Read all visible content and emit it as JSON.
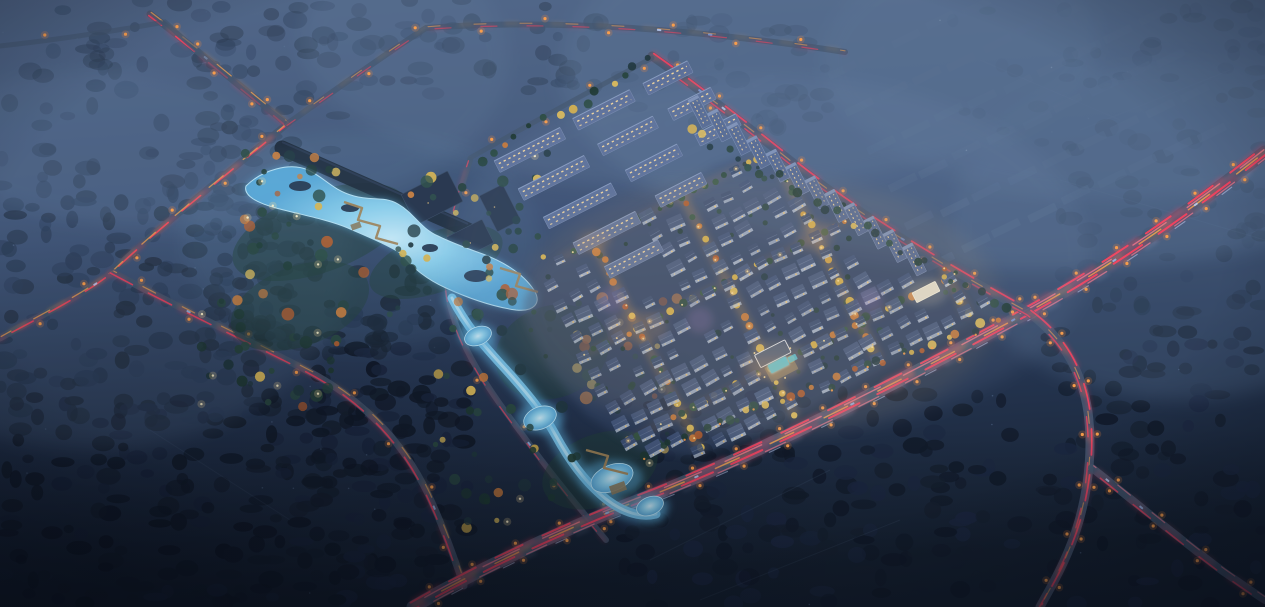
{
  "scene": {
    "description": "aerial-night-rendering-of-residential-development-with-park-and-roads",
    "canvas": {
      "width": 1265,
      "height": 607
    },
    "palette": {
      "bg_top": "#4d6183",
      "bg_mid": "#394d70",
      "bg_low": "#24344f",
      "bg_bottom": "#15202f",
      "haze": "#5f7899",
      "forest": [
        "#1c2b41",
        "#17212f",
        "#233450",
        "#1a2638"
      ],
      "forest_dark": [
        "#121b2a",
        "#16202f",
        "#1b2740",
        "#101827"
      ],
      "village": "#4b5f80",
      "road": "#45576f",
      "trail_red": "#f5415f",
      "trail_pink": "#ff7b92",
      "trail_amber": "#ffaa4e",
      "trail_head": "#c9d9ff",
      "lamp": "#ffa04a",
      "lamp_halo": "#ff8c3a",
      "water": "#7cc8ee",
      "water_hi": "#c8eefc",
      "water_halo": "#5fb5e5",
      "autumn": [
        "#cd7d3a",
        "#dcb54c",
        "#b35c2c",
        "#e3c05a"
      ],
      "green": [
        "#27443c",
        "#1f3a33",
        "#2c4c42",
        "#21383f"
      ],
      "lane_warm": [
        "#dcb54c",
        "#e3c05a",
        "#d9a844",
        "#dcb54c",
        "#cd7d3a",
        "#b35c2c",
        "#3a5a46"
      ],
      "lane_green": [
        "#3a5a46",
        "#2e4c3e",
        "#cd7d3a",
        "#3a5a46",
        "#dcb54c",
        "#2e4c3e"
      ],
      "boardwalk": "#a08357",
      "roof": [
        "#41547a",
        "#485b80",
        "#3c4f73"
      ],
      "facade": "#c3cfe2",
      "window": "#ffd27c",
      "window2": "#ffe6a8",
      "slab": "#5d7099",
      "slab_win": "#ffdf9f",
      "slab_edge": "#8fa3c6",
      "tower": "#566a92",
      "tower_cap": "#8598bc",
      "pool": "#41c8e4",
      "plaza": "#8d7f62",
      "club_roof": "#3e5070",
      "club_rim": "#e8eef8",
      "office": "#e6e0cf",
      "glow_warm": "#ffab55",
      "glow_purple": "#c98fd6",
      "cars": [
        "#9db8ea",
        "#b8ccf4",
        "#7f9cd8"
      ],
      "dark_building": "#232e45",
      "dark_building_edge": "#37465f",
      "wall": "#1c2736"
    },
    "haze_spots": [
      [
        1040,
        70,
        480,
        200,
        0.4
      ],
      [
        700,
        40,
        400,
        150,
        0.32
      ],
      [
        180,
        60,
        330,
        170,
        0.28
      ],
      [
        90,
        260,
        260,
        190,
        0.22
      ],
      [
        1180,
        230,
        230,
        170,
        0.26
      ],
      [
        1120,
        60,
        300,
        140,
        0.3
      ]
    ],
    "forest_patches": [
      {
        "x": 0,
        "y": 30,
        "w": 340,
        "h": 190,
        "n": 80,
        "o": 0.5,
        "dark": false
      },
      {
        "x": 0,
        "y": 190,
        "w": 290,
        "h": 230,
        "n": 130,
        "o": 0.8,
        "dark": false
      },
      {
        "x": 0,
        "y": 390,
        "w": 470,
        "h": 217,
        "n": 200,
        "o": 0.95,
        "dark": true
      },
      {
        "x": 250,
        "y": 320,
        "w": 230,
        "h": 250,
        "n": 90,
        "o": 0.9,
        "dark": true
      },
      {
        "x": 620,
        "y": 390,
        "w": 400,
        "h": 217,
        "n": 160,
        "o": 0.9,
        "dark": true
      },
      {
        "x": 1040,
        "y": 330,
        "w": 225,
        "h": 277,
        "n": 90,
        "o": 0.85,
        "dark": true
      },
      {
        "x": 1055,
        "y": 140,
        "w": 210,
        "h": 175,
        "n": 50,
        "o": 0.5,
        "dark": false
      },
      {
        "x": 330,
        "y": 0,
        "w": 290,
        "h": 95,
        "n": 45,
        "o": 0.5,
        "dark": false
      },
      {
        "x": 55,
        "y": 0,
        "w": 270,
        "h": 70,
        "n": 30,
        "o": 0.45,
        "dark": false
      },
      {
        "x": 185,
        "y": 115,
        "w": 125,
        "h": 230,
        "n": 55,
        "o": 0.75,
        "dark": false
      },
      {
        "x": 950,
        "y": 0,
        "w": 315,
        "h": 145,
        "n": 45,
        "o": 0.32,
        "dark": false
      },
      {
        "x": 300,
        "y": 245,
        "w": 150,
        "h": 115,
        "n": 40,
        "o": 0.8,
        "dark": false
      },
      {
        "x": 620,
        "y": 20,
        "w": 210,
        "h": 120,
        "n": 35,
        "o": 0.4,
        "dark": false
      }
    ],
    "village_grids": [
      {
        "x": 840,
        "y": 70,
        "ux": 34,
        "uy": -16,
        "vx": 20,
        "vy": 38,
        "cols": 9,
        "rows": 6,
        "w": 30,
        "h": 8,
        "rot": -26,
        "o": 0.5
      },
      {
        "x": 628,
        "y": 100,
        "ux": 30,
        "uy": -13,
        "vx": 17,
        "vy": 32,
        "cols": 5,
        "rows": 3,
        "w": 24,
        "h": 6,
        "rot": -26,
        "o": 0.3
      }
    ],
    "field_lines": [
      "M1060,180 L1265,240",
      "M1080,130 L1230,70",
      "M650,560 L830,470",
      "M700,600 L900,520",
      "M150,430 L290,520",
      "M980,60 L1120,120"
    ],
    "roads": [
      {
        "name": "north-road",
        "d": "M150,14 C200,52 252,96 287,124 C232,170 160,226 112,272 C82,296 32,320 0,338",
        "w": 7,
        "o": 0.85,
        "lampSpacing": 58,
        "lampSides": 1,
        "cars": 2,
        "trails": [
          {
            "dx": -1.2,
            "dy": 1.6,
            "c": "red",
            "w": 1.6,
            "dash": "24 18",
            "o": 0.9
          },
          {
            "dx": 1.2,
            "dy": -1.6,
            "c": "amber",
            "w": 1.3,
            "dash": "18 26",
            "o": 0.7
          }
        ]
      },
      {
        "name": "north-road-west-branch",
        "d": "M287,124 C244,92 202,56 165,22 C120,30 55,40 0,46",
        "w": 5,
        "o": 0.6,
        "lampSpacing": 80,
        "lampSides": 1,
        "cars": 0,
        "trails": []
      },
      {
        "name": "north-road-east",
        "d": "M287,124 C330,94 382,56 426,28 C560,18 700,30 845,52",
        "w": 6,
        "o": 0.7,
        "lampSpacing": 64,
        "lampSides": 1,
        "cars": 2,
        "trails": [
          {
            "dx": 0,
            "dy": 1.4,
            "c": "red",
            "w": 1.2,
            "dash": "16 30",
            "o": 0.55
          },
          {
            "dx": 0,
            "dy": -1.2,
            "c": "amber",
            "w": 1.1,
            "dash": "12 34",
            "o": 0.5
          }
        ]
      },
      {
        "name": "west-road",
        "d": "M112,272 C190,314 256,344 302,368 C362,398 402,440 428,494 C444,528 454,558 464,586",
        "w": 7,
        "o": 0.85,
        "lampSpacing": 60,
        "lampSides": 1,
        "cars": 2,
        "trails": [
          {
            "dx": -1.8,
            "dy": 0.9,
            "c": "red",
            "w": 1.6,
            "dash": "26 18",
            "o": 0.85
          },
          {
            "dx": 1.8,
            "dy": -0.9,
            "c": "amber",
            "w": 1.2,
            "dash": "14 30",
            "o": 0.6
          }
        ]
      },
      {
        "name": "park-edge-road",
        "d": "M470,160 C452,214 442,254 448,296 C458,348 492,394 522,434 C548,470 576,504 606,540",
        "w": 6,
        "o": 0.8,
        "lampSpacing": 65,
        "lampSides": 1,
        "cars": 1,
        "trails": [
          {
            "dx": -1.5,
            "dy": 0.8,
            "c": "red",
            "w": 1.3,
            "dash": "20 26",
            "o": 0.7
          }
        ]
      },
      {
        "name": "main-avenue",
        "d": "M413,607 C470,574 560,530 655,494 C760,452 900,382 1028,312 C1110,267 1190,211 1265,152",
        "w": 13,
        "o": 0.9,
        "lampSpacing": 48,
        "lampSides": 2,
        "cars": 6,
        "trails": [
          {
            "dx": -2.4,
            "dy": -4.4,
            "c": "red",
            "w": 2.0,
            "dash": "30 22",
            "o": 0.95
          },
          {
            "dx": -1.2,
            "dy": -2.2,
            "c": "pink",
            "w": 1.4,
            "dash": "40 26",
            "o": 0.75
          },
          {
            "dx": 0,
            "dy": 0,
            "c": "amber",
            "w": 1.5,
            "dash": "26 34",
            "o": 0.8
          },
          {
            "dx": 1.2,
            "dy": 2.2,
            "c": "red",
            "w": 2.0,
            "dash": "34 20",
            "o": 0.95
          },
          {
            "dx": 2.6,
            "dy": 4.6,
            "c": "pink",
            "w": 1.3,
            "dash": "22 30",
            "o": 0.65
          },
          {
            "dx": 3.8,
            "dy": 6.6,
            "c": "head",
            "w": 1.1,
            "dash": "12 46",
            "o": 0.5
          }
        ]
      },
      {
        "name": "east-boundary-road",
        "d": "M652,56 C692,84 742,122 792,162 C862,218 952,270 1028,312 C1064,338 1082,372 1088,412 C1094,458 1086,510 1068,552 C1058,576 1048,592 1040,607",
        "w": 9,
        "o": 0.88,
        "lampSpacing": 52,
        "lampSides": 2,
        "cars": 3,
        "trails": [
          {
            "dx": 1.8,
            "dy": -2.4,
            "c": "red",
            "w": 1.7,
            "dash": "26 20",
            "o": 0.9
          },
          {
            "dx": -1.8,
            "dy": 2.4,
            "c": "red",
            "w": 1.5,
            "dash": "20 26",
            "o": 0.75
          },
          {
            "dx": 0,
            "dy": 0,
            "c": "amber",
            "w": 1.2,
            "dash": "12 34",
            "o": 0.55
          }
        ]
      },
      {
        "name": "southeast-branch-road",
        "d": "M1092,468 C1130,498 1178,538 1224,572 C1240,583 1254,593 1265,600",
        "w": 8,
        "o": 0.85,
        "lampSpacing": 56,
        "lampSides": 2,
        "cars": 2,
        "trails": [
          {
            "dx": -1.7,
            "dy": 2.2,
            "c": "red",
            "w": 1.5,
            "dash": "22 20",
            "o": 0.8
          },
          {
            "dx": 1.7,
            "dy": -2.2,
            "c": "pink",
            "w": 1.2,
            "dash": "16 28",
            "o": 0.6
          }
        ]
      },
      {
        "name": "northwest-boundary-road",
        "d": "M470,158 C530,124 592,90 652,58",
        "w": 5,
        "o": 0.65,
        "lampSpacing": 56,
        "lampSides": 1,
        "cars": 0,
        "trails": []
      }
    ],
    "park": {
      "lawns": [
        [
          320,
          232,
          92,
          40
        ],
        [
          436,
          262,
          70,
          30
        ],
        [
          552,
          352,
          58,
          46
        ],
        [
          300,
          306,
          72,
          40
        ],
        [
          600,
          470,
          60,
          36
        ]
      ],
      "lake": "M246,186 C262,170 290,162 308,170 C324,177 332,190 354,196 C372,201 384,196 398,204 C414,213 420,228 438,236 C452,243 466,248 480,253 C500,260 522,272 534,290 C542,303 534,312 516,310 C494,307 468,298 446,288 C428,280 412,268 402,254 C386,244 366,236 348,228 C326,219 298,214 276,208 C258,203 243,196 246,186 Z",
      "islands": [
        [
          300,
          186,
          11,
          5
        ],
        [
          350,
          208,
          9,
          4
        ],
        [
          476,
          276,
          12,
          6
        ],
        [
          430,
          248,
          8,
          4
        ]
      ],
      "stream": {
        "d": "M452,298 C468,330 490,352 508,372 C526,392 543,412 556,436 C568,458 582,478 600,494 C620,512 640,518 656,514",
        "w": 9
      },
      "ponds": [
        [
          478,
          336,
          14,
          9
        ],
        [
          540,
          418,
          17,
          11
        ],
        [
          612,
          478,
          22,
          13
        ],
        [
          650,
          506,
          14,
          9
        ]
      ],
      "boardwalks": [
        "344,202 362,208 358,220 380,226 376,238 398,244",
        "500,268 520,274 516,286 538,292",
        "586,450 608,456 604,468 628,474"
      ],
      "decks": [
        [
          618,
          488,
          16,
          9
        ],
        [
          356,
          226,
          10,
          6
        ]
      ],
      "wall": {
        "d": "M282,148 L468,230",
        "w": 15
      },
      "dark_buildings": [
        [
          432,
          198,
          52,
          34
        ],
        [
          470,
          240,
          40,
          26
        ],
        [
          500,
          208,
          26,
          40
        ]
      ],
      "tree_bands": [
        {
          "x": 236,
          "y": 148,
          "w": 320,
          "h": 168,
          "n": 70,
          "ap": 0.45
        },
        {
          "x": 430,
          "y": 290,
          "w": 250,
          "h": 240,
          "n": 60,
          "ap": 0.5
        },
        {
          "x": 200,
          "y": 300,
          "w": 140,
          "h": 110,
          "n": 26,
          "ap": 0.15
        }
      ],
      "lights_n": 18
    },
    "development": {
      "polygon": [
        [
          524,
          300
        ],
        [
          540,
          272
        ],
        [
          570,
          250
        ],
        [
          620,
          222
        ],
        [
          680,
          186
        ],
        [
          715,
          165
        ],
        [
          760,
          150
        ],
        [
          790,
          170
        ],
        [
          850,
          205
        ],
        [
          910,
          243
        ],
        [
          960,
          276
        ],
        [
          1000,
          302
        ],
        [
          962,
          328
        ],
        [
          900,
          360
        ],
        [
          835,
          395
        ],
        [
          765,
          430
        ],
        [
          698,
          456
        ],
        [
          640,
          450
        ],
        [
          586,
          415
        ],
        [
          548,
          366
        ],
        [
          524,
          318
        ]
      ],
      "ground_color": "#3b4e70",
      "ground_o": 0.45,
      "house": {
        "ax": 505,
        "ay": 200,
        "ux": 17.8,
        "uy": -9.1,
        "vx": 8.8,
        "vy": 17.2,
        "ni": 33,
        "nj": 18,
        "skip": 0.12,
        "angle": -27
      },
      "avoid": [
        [
          778,
          362,
          30
        ],
        [
          926,
          292,
          22
        ]
      ],
      "lanes_i": [
        3,
        8,
        13,
        18,
        23,
        28
      ],
      "lanes_j": [
        4,
        9,
        14
      ],
      "apartments": [
        [
          530,
          150,
          74
        ],
        [
          604,
          110,
          64
        ],
        [
          668,
          78,
          50
        ],
        [
          554,
          178,
          74
        ],
        [
          628,
          136,
          62
        ],
        [
          692,
          104,
          48
        ],
        [
          580,
          206,
          76
        ],
        [
          654,
          163,
          58
        ],
        [
          718,
          130,
          46
        ],
        [
          607,
          233,
          70
        ],
        [
          681,
          190,
          52
        ],
        [
          634,
          259,
          60
        ]
      ],
      "towers": {
        "x": 700,
        "y": 112,
        "dx": 19.5,
        "dy": 13.4,
        "n": 12
      },
      "clubhouse": {
        "x": 776,
        "y": 360
      },
      "office": {
        "x": 926,
        "y": 292
      },
      "perimeter_lines": [
        {
          "x1": 648,
          "y1": 452,
          "x2": 995,
          "y2": 318,
          "n": 30,
          "ap": 0.5,
          "lampEvery": 3
        },
        {
          "x1": 688,
          "y1": 128,
          "x2": 1005,
          "y2": 308,
          "n": 26,
          "ap": 0.15,
          "lampEvery": 0
        },
        {
          "x1": 478,
          "y1": 160,
          "x2": 650,
          "y2": 62,
          "n": 14,
          "ap": 0.2,
          "lampEvery": 0
        }
      ],
      "glow_purple": [
        [
          700,
          320
        ],
        [
          612,
          300
        ],
        [
          870,
          300
        ]
      ],
      "courtyard_trees": 70
    },
    "bloom": [
      {
        "x": 770,
        "y": 255,
        "rx": 320,
        "ry": 180,
        "c": "#8aa0c6",
        "o": 0.1
      },
      {
        "x": 760,
        "y": 305,
        "rx": 240,
        "ry": 130,
        "c": "#d8ab6e",
        "o": 0.09
      },
      {
        "x": 360,
        "y": 240,
        "rx": 180,
        "ry": 110,
        "c": "#7fb8d8",
        "o": 0.08
      }
    ]
  }
}
